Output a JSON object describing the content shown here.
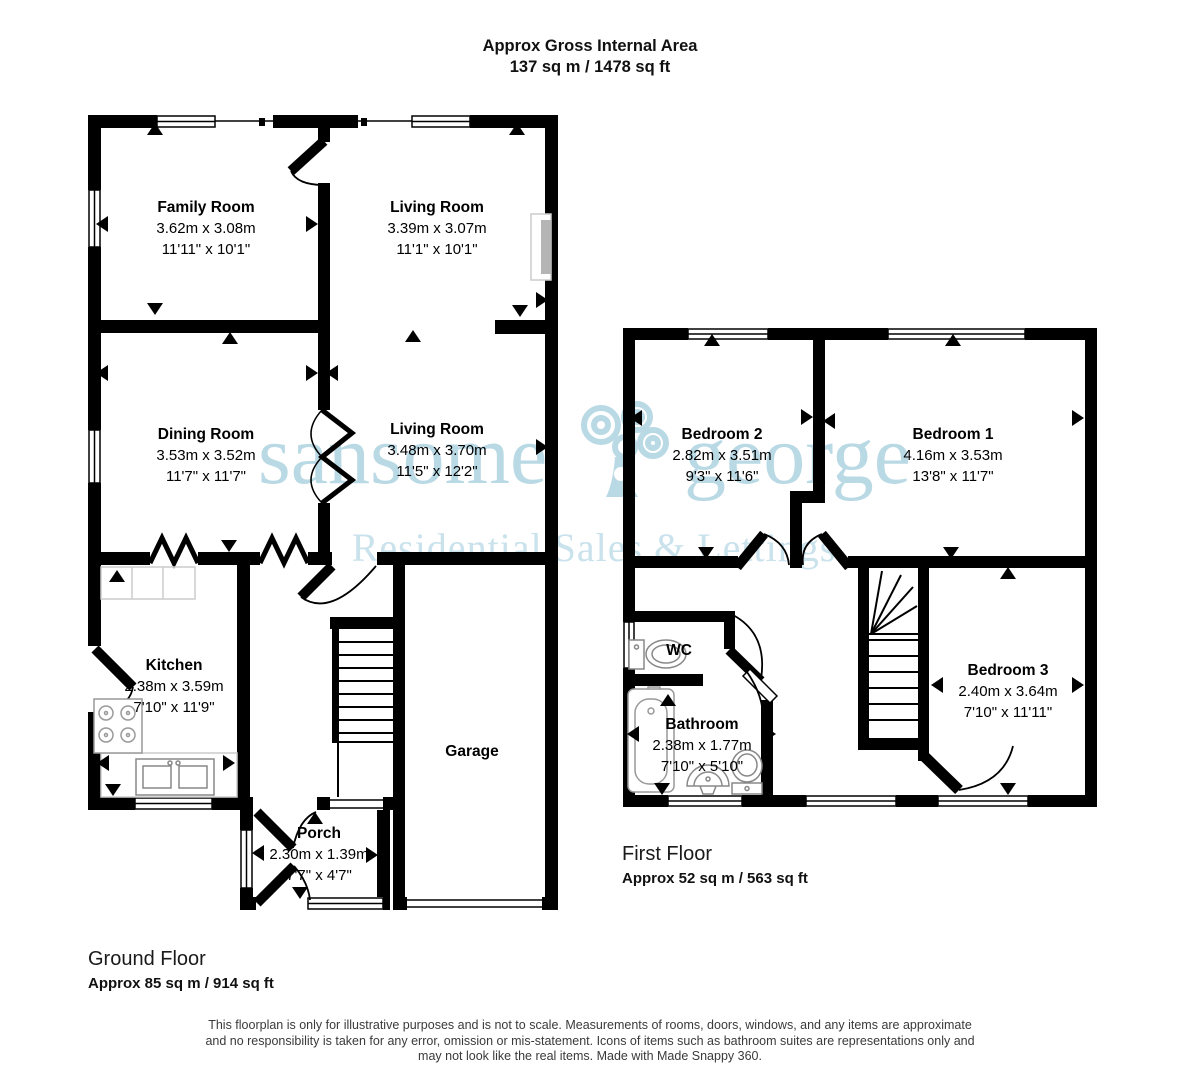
{
  "title": {
    "line1": "Approx Gross Internal Area",
    "line2": "137 sq m / 1478 sq ft"
  },
  "watermark": {
    "word1": "sansome",
    "word2": "george",
    "tagline": "Residential Sales & Lettings"
  },
  "colors": {
    "walls": "#000000",
    "background": "#ffffff",
    "watermark": "#b9d9e5",
    "watermark_tagline": "#c9e2ec"
  },
  "ground_floor": {
    "label": "Ground Floor",
    "area": "Approx 85 sq m / 914 sq ft",
    "rooms": {
      "family_room": {
        "name": "Family Room",
        "metric": "3.62m x 3.08m",
        "imperial": "11'11\" x 10'1\""
      },
      "living_room_front": {
        "name": "Living Room",
        "metric": "3.39m x 3.07m",
        "imperial": "11'1\" x 10'1\""
      },
      "dining_room": {
        "name": "Dining Room",
        "metric": "3.53m x 3.52m",
        "imperial": "11'7\" x 11'7\""
      },
      "living_room_rear": {
        "name": "Living Room",
        "metric": "3.48m x 3.70m",
        "imperial": "11'5\" x 12'2\""
      },
      "kitchen": {
        "name": "Kitchen",
        "metric": "2.38m x 3.59m",
        "imperial": "7'10\" x 11'9\""
      },
      "garage": {
        "name": "Garage"
      },
      "porch": {
        "name": "Porch",
        "metric": "2.30m x 1.39m",
        "imperial": "7'7\" x 4'7\""
      }
    }
  },
  "first_floor": {
    "label": "First Floor",
    "area": "Approx 52 sq m / 563 sq ft",
    "rooms": {
      "bedroom_2": {
        "name": "Bedroom 2",
        "metric": "2.82m x 3.51m",
        "imperial": "9'3\" x 11'6\""
      },
      "bedroom_1": {
        "name": "Bedroom 1",
        "metric": "4.16m x 3.53m",
        "imperial": "13'8\" x 11'7\""
      },
      "bedroom_3": {
        "name": "Bedroom 3",
        "metric": "2.40m x 3.64m",
        "imperial": "7'10\" x 11'11\""
      },
      "wc": {
        "name": "WC"
      },
      "bathroom": {
        "name": "Bathroom",
        "metric": "2.38m x 1.77m",
        "imperial": "7'10\" x 5'10\""
      }
    }
  },
  "disclaimer": {
    "line1": "This floorplan is only for illustrative purposes and is not to scale. Measurements of rooms, doors, windows, and any items are approximate",
    "line2": "and no responsibility is taken for any error, omission or mis-statement. Icons of items such as bathroom suites are representations only and",
    "line3": "may not look like the real items. Made with Made Snappy 360."
  }
}
